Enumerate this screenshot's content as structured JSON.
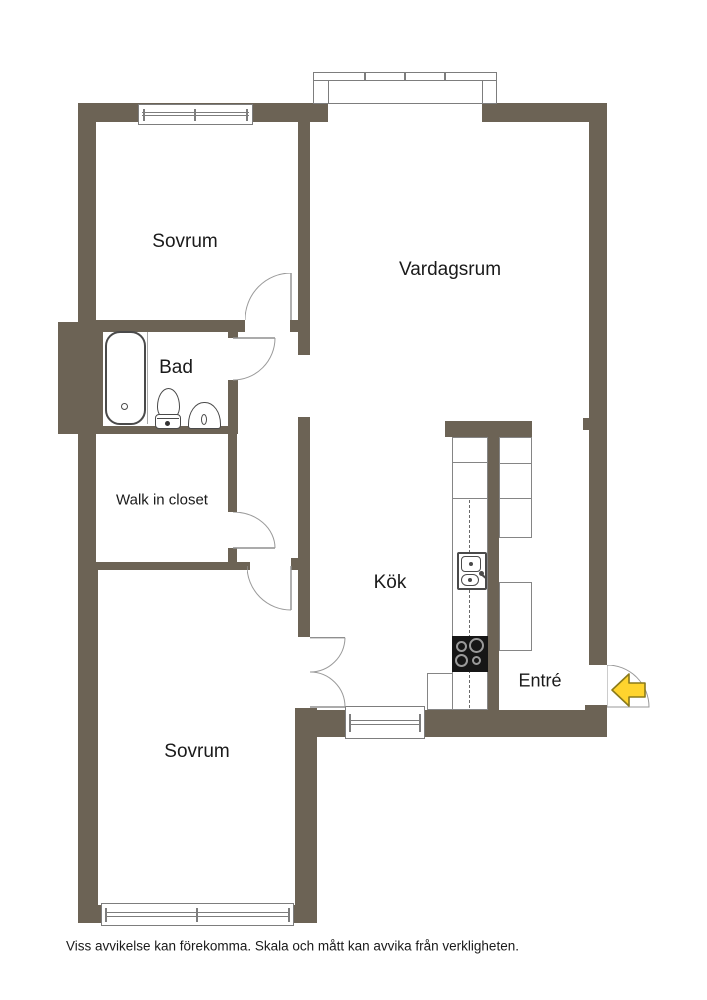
{
  "floor_plan": {
    "rooms": {
      "bedroom_top": {
        "label": "Sovrum"
      },
      "living_room": {
        "label": "Vardagsrum"
      },
      "bathroom": {
        "label": "Bad"
      },
      "walk_in_closet": {
        "label": "Walk in closet"
      },
      "kitchen": {
        "label": "Kök"
      },
      "entry": {
        "label": "Entré"
      },
      "bedroom_bottom": {
        "label": "Sovrum"
      }
    },
    "disclaimer": "Viss avvikelse kan förekomma. Skala och mått kan avvika från verkligheten.",
    "colors": {
      "wall": "#6c6355",
      "window_frame": "#7d7d7d",
      "counter_outline": "#858585",
      "fixture_outline": "#4a4a4a",
      "door_arc": "#909090",
      "arrow_fill": "#ffd42e",
      "arrow_stroke": "#8a7a1a",
      "label_text": "#1a1a1a",
      "background": "#ffffff"
    }
  }
}
